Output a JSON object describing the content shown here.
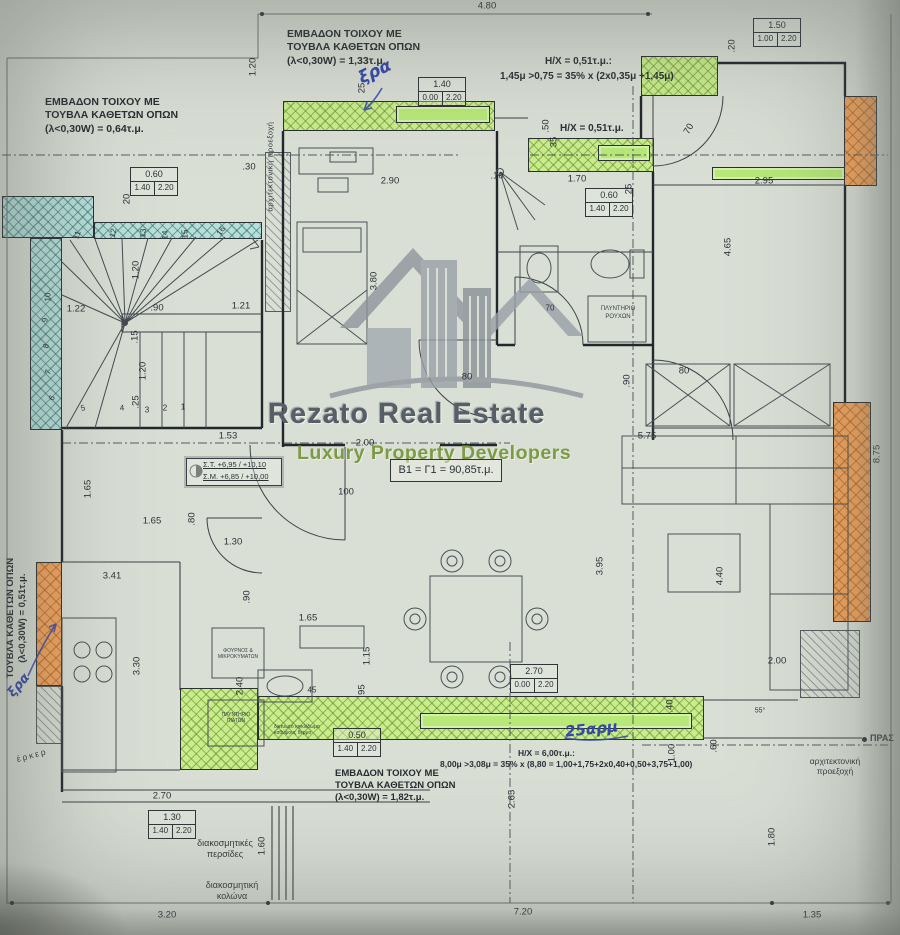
{
  "watermark": {
    "brand": "Rezato Real Estate",
    "tagline": "Luxury Property Developers"
  },
  "wall_area_notes": {
    "top": [
      "ΕΜΒΑΔΟΝ ΤΟΙΧΟΥ ΜΕ",
      "ΤΟΥΒΛΑ ΚΑΘΕΤΩΝ ΟΠΩΝ",
      "(λ<0,30W) = 1,33τ.μ."
    ],
    "left": [
      "ΕΜΒΑΔΟΝ ΤΟΙΧΟΥ ΜΕ",
      "ΤΟΥΒΛΑ ΚΑΘΕΤΩΝ ΟΠΩΝ",
      "(λ<0,30W) = 0,64τ.μ."
    ],
    "bottom": [
      "ΕΜΒΑΔΟΝ ΤΟΙΧΟΥ ΜΕ",
      "ΤΟΥΒΛΑ ΚΑΘΕΤΩΝ ΟΠΩΝ",
      "(λ<0,30W) = 1,82τ.μ."
    ],
    "side_vertical": [
      "ΤΟΥΒΛΑ ΚΑΘΕΤΩΝ ΟΠΩΝ",
      "(λ<0,30W) = 0,51τ.μ."
    ]
  },
  "hx_notes": {
    "top1": "Η/Χ = 0,51τ.μ.:",
    "top2": "1,45μ >0,75 = 35% x (2x0,35μ +1,45μ)",
    "mid": "Η/Χ = 0,51τ.μ.",
    "bottom1": "Η/Χ = 6,00τ.μ.:",
    "bottom2": "8,00μ >3,08μ = 35% x (8,80 = 1,00+1,75+2x0,40+0,50+3,75+1,00)"
  },
  "unit": {
    "area_label": "Β1 = Γ1 = 90,85τ.μ."
  },
  "levels": {
    "line1": "Σ.Τ.  +6,95 / +10,10",
    "line2": "Σ.Μ.  +6,85 / +10,00"
  },
  "fixtures": {
    "washer": [
      "ΠΛΥΝΤΗΡΙΟ",
      "ΡΟΥΧΩΝ"
    ],
    "oven": [
      "ΦΟΥΡΝΟΣ &",
      "ΜΙΚΡΟΚΥΜΑΤΩΝ"
    ],
    "dishwasher": [
      "ΠΛΥΝΤΗΡΙΟ",
      "ΠΙΑΤΩΝ"
    ],
    "grille": [
      "δικτυωτό κιγκλίδωμα",
      "καθύψους θερμο"
    ]
  },
  "site_notes": {
    "louvers": [
      "διακοσμητικές",
      "περσίδες"
    ],
    "column": [
      "διακοσμητική",
      "κολώνα"
    ],
    "projection_right": [
      "αρχιτεκτονική",
      "προεξοχή"
    ],
    "projection_top_vertical": "αρχιτεκτονική προεξοχή",
    "prasia": "ΠΡΑΣ",
    "erker": "έρκερ"
  },
  "handwritten": {
    "top": "ξρα",
    "left": "ξρα",
    "bottom": "25αρμ"
  },
  "openings": [
    {
      "width": "0.60",
      "sill": "1.40",
      "head": "2.20"
    },
    {
      "width": "1.40",
      "sill": "0.00",
      "head": "2.20"
    },
    {
      "width": "1.50",
      "sill": "1.00",
      "head": "2.20"
    },
    {
      "width": "0.60",
      "sill": "1.40",
      "head": "2.20"
    },
    {
      "width": "0.50",
      "sill": "1.40",
      "head": "2.20"
    },
    {
      "width": "2.70",
      "sill": "0.00",
      "head": "2.20"
    },
    {
      "width": "1.30",
      "sill": "1.40",
      "head": "2.20"
    }
  ],
  "dimensions": [
    {
      "t": "4.80",
      "x": 487,
      "y": 6,
      "r": 0
    },
    {
      "t": ".20",
      "x": 732,
      "y": 46,
      "r": -90
    },
    {
      "t": "2.90",
      "x": 390,
      "y": 181,
      "r": 0
    },
    {
      "t": ".10",
      "x": 497,
      "y": 176,
      "r": 0
    },
    {
      "t": "1.70",
      "x": 577,
      "y": 179,
      "r": 0
    },
    {
      "t": "25",
      "x": 629,
      "y": 189,
      "r": -90
    },
    {
      "t": "2.95",
      "x": 764,
      "y": 181,
      "r": 0
    },
    {
      "t": "20",
      "x": 127,
      "y": 199,
      "r": -90
    },
    {
      "t": "25",
      "x": 362,
      "y": 88,
      "r": -90
    },
    {
      "t": ".50",
      "x": 546,
      "y": 126,
      "r": -90
    },
    {
      "t": "35",
      "x": 554,
      "y": 142,
      "r": -90
    },
    {
      "t": "70",
      "x": 689,
      "y": 129,
      "r": -60
    },
    {
      "t": "4.65",
      "x": 728,
      "y": 247,
      "r": -90
    },
    {
      "t": "3.80",
      "x": 374,
      "y": 281,
      "r": -90
    },
    {
      "t": "1.20",
      "x": 253,
      "y": 67,
      "r": -90
    },
    {
      "t": ".30",
      "x": 249,
      "y": 167,
      "r": 0
    },
    {
      "t": "1.20",
      "x": 136,
      "y": 270,
      "r": -90
    },
    {
      "t": "1.22",
      "x": 76,
      "y": 309,
      "r": 0
    },
    {
      "t": ".90",
      "x": 157,
      "y": 308,
      "r": 0
    },
    {
      "t": "1.21",
      "x": 241,
      "y": 306,
      "r": 0
    },
    {
      "t": ".15",
      "x": 135,
      "y": 337,
      "r": -90
    },
    {
      "t": "1.20",
      "x": 143,
      "y": 371,
      "r": -90
    },
    {
      "t": ".25",
      "x": 136,
      "y": 402,
      "r": -90
    },
    {
      "t": "1.53",
      "x": 228,
      "y": 436,
      "r": 0
    },
    {
      "t": "2.00",
      "x": 365,
      "y": 443,
      "r": 0
    },
    {
      "t": "100",
      "x": 346,
      "y": 492,
      "r": 0
    },
    {
      "t": "80",
      "x": 467,
      "y": 377,
      "r": 0
    },
    {
      "t": "80",
      "x": 684,
      "y": 371,
      "r": 0
    },
    {
      "t": ".90",
      "x": 627,
      "y": 381,
      "r": -90
    },
    {
      "t": "1.65",
      "x": 88,
      "y": 489,
      "r": -90
    },
    {
      "t": "1.65",
      "x": 152,
      "y": 521,
      "r": 0
    },
    {
      "t": "1.30",
      "x": 233,
      "y": 542,
      "r": 0
    },
    {
      "t": ".80",
      "x": 192,
      "y": 519,
      "r": -90
    },
    {
      "t": "3.41",
      "x": 112,
      "y": 576,
      "r": 0
    },
    {
      "t": ".90",
      "x": 247,
      "y": 597,
      "r": -90
    },
    {
      "t": "1.65",
      "x": 308,
      "y": 618,
      "r": 0
    },
    {
      "t": "1.15",
      "x": 367,
      "y": 656,
      "r": -90
    },
    {
      "t": "2.40",
      "x": 240,
      "y": 686,
      "r": -90
    },
    {
      "t": "3.30",
      "x": 137,
      "y": 666,
      "r": -90
    },
    {
      "t": "45",
      "x": 312,
      "y": 690,
      "r": 0,
      "s": 8
    },
    {
      "t": ".95",
      "x": 362,
      "y": 691,
      "r": -90
    },
    {
      "t": "2.70",
      "x": 162,
      "y": 796,
      "r": 0
    },
    {
      "t": "5.75",
      "x": 647,
      "y": 436,
      "r": 0
    },
    {
      "t": "3.95",
      "x": 600,
      "y": 566,
      "r": -90
    },
    {
      "t": "4.40",
      "x": 720,
      "y": 576,
      "r": -90
    },
    {
      "t": "2.00",
      "x": 777,
      "y": 661,
      "r": 0
    },
    {
      "t": "8.75",
      "x": 877,
      "y": 454,
      "r": -90
    },
    {
      "t": ".60",
      "x": 714,
      "y": 746,
      "r": -90
    },
    {
      "t": "1.00",
      "x": 672,
      "y": 753,
      "r": -90
    },
    {
      "t": ".40",
      "x": 670,
      "y": 706,
      "r": -90
    },
    {
      "t": "55°",
      "x": 760,
      "y": 711,
      "r": 0,
      "s": 7
    },
    {
      "t": "2.65",
      "x": 512,
      "y": 799,
      "r": -90
    },
    {
      "t": "1.80",
      "x": 772,
      "y": 837,
      "r": -90
    },
    {
      "t": "1.60",
      "x": 262,
      "y": 846,
      "r": -90
    },
    {
      "t": "3.20",
      "x": 167,
      "y": 915,
      "r": 0
    },
    {
      "t": "7.20",
      "x": 523,
      "y": 912,
      "r": 0
    },
    {
      "t": "1.35",
      "x": 812,
      "y": 915,
      "r": 0
    },
    {
      "t": "70",
      "x": 550,
      "y": 308,
      "r": 0,
      "s": 8
    },
    {
      "t": "11",
      "x": 77,
      "y": 235,
      "r": -70,
      "s": 8
    },
    {
      "t": "12",
      "x": 113,
      "y": 233,
      "r": -78,
      "s": 8
    },
    {
      "t": "13",
      "x": 143,
      "y": 233,
      "r": -85,
      "s": 8
    },
    {
      "t": "14",
      "x": 165,
      "y": 235,
      "r": -88,
      "s": 8
    },
    {
      "t": "15",
      "x": 185,
      "y": 234,
      "r": -90,
      "s": 8
    },
    {
      "t": "16",
      "x": 221,
      "y": 231,
      "r": -55,
      "s": 8
    },
    {
      "t": "10",
      "x": 48,
      "y": 297,
      "r": -90,
      "s": 8
    },
    {
      "t": "9",
      "x": 45,
      "y": 320,
      "r": -85,
      "s": 8
    },
    {
      "t": "8",
      "x": 46,
      "y": 346,
      "r": -78,
      "s": 8
    },
    {
      "t": "7",
      "x": 48,
      "y": 372,
      "r": -70,
      "s": 8
    },
    {
      "t": "6",
      "x": 52,
      "y": 398,
      "r": -60,
      "s": 8
    },
    {
      "t": "5",
      "x": 83,
      "y": 408,
      "r": -15,
      "s": 8
    },
    {
      "t": "4",
      "x": 122,
      "y": 408,
      "r": -5,
      "s": 8
    },
    {
      "t": "3",
      "x": 147,
      "y": 410,
      "r": 0,
      "s": 8
    },
    {
      "t": "2",
      "x": 165,
      "y": 408,
      "r": 0,
      "s": 8
    },
    {
      "t": "1",
      "x": 183,
      "y": 407,
      "r": 0,
      "s": 8
    }
  ],
  "colors": {
    "highlight_green": "#c9ec8d",
    "highlight_orange": "#f2a45f",
    "highlight_teal": "#badfdb",
    "window_green": "#b7e878",
    "handwriting_blue": "#3547a8",
    "watermark_gray": "#8e959c",
    "watermark_green": "#7d9b42",
    "paper": "#dadfd6"
  }
}
